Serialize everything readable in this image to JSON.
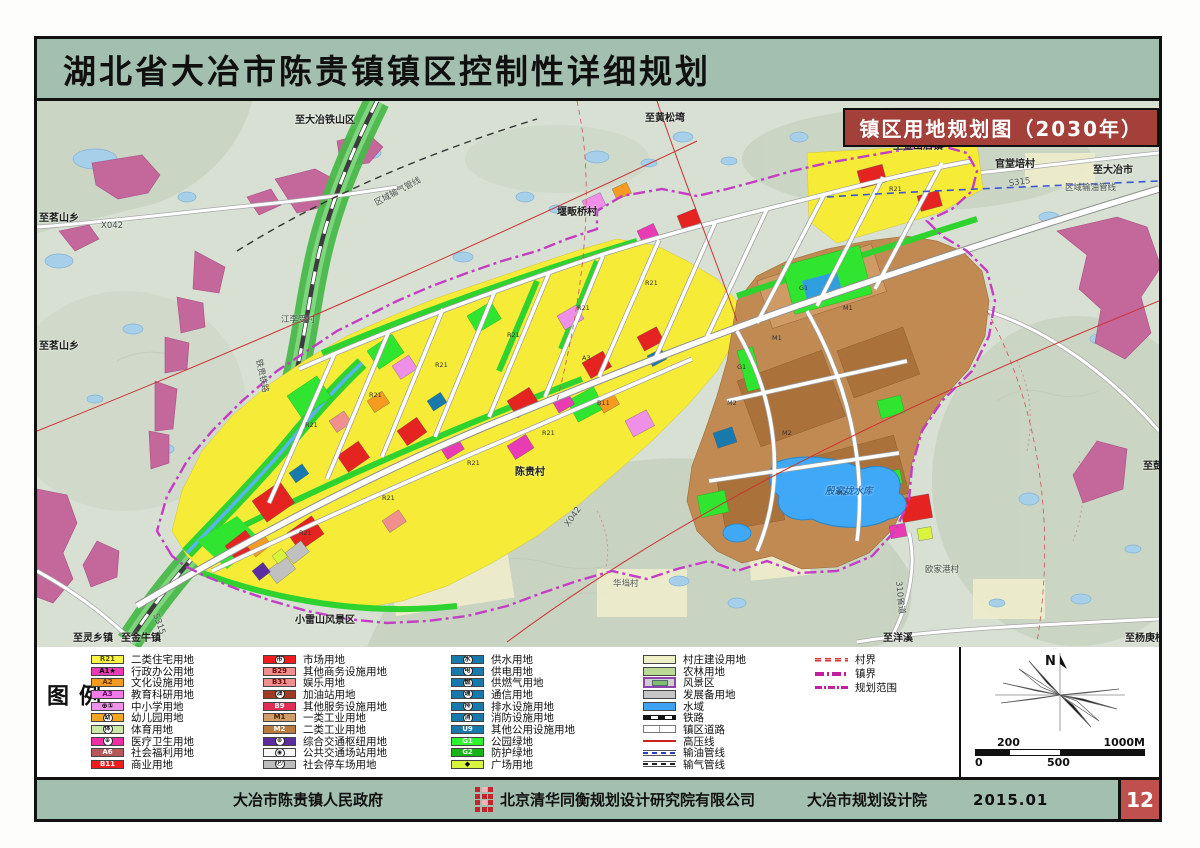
{
  "title": "湖北省大冶市陈贵镇镇区控制性详细规划",
  "badge": "镇区用地规划图（2030年）",
  "legend": {
    "title": "图例",
    "cols": [
      [
        {
          "c": "R21",
          "f": "#fdf546",
          "tc": "#555500",
          "label": "二类住宅用地"
        },
        {
          "c": "A1★",
          "f": "#e93cb4",
          "tc": "#000",
          "label": "行政办公用地"
        },
        {
          "c": "A2",
          "f": "#f59b21",
          "tc": "#6a3500",
          "label": "文化设施用地"
        },
        {
          "c": "A3",
          "f": "#f07ae8",
          "tc": "#6a006a",
          "label": "教育科研用地"
        },
        {
          "c": "⊕①",
          "f": "#ef93ea",
          "tc": "#000",
          "label": "中小学用地"
        },
        {
          "c": "幼",
          "f": "#f5a623",
          "circle": true,
          "label": "幼儿园用地"
        },
        {
          "c": "体",
          "f": "#cde8a6",
          "circle": true,
          "label": "体育用地"
        },
        {
          "c": "⊕",
          "f": "#ee2fa4",
          "circle": true,
          "label": "医疗卫生用地"
        },
        {
          "c": "A6",
          "f": "#b35959",
          "tc": "#fff",
          "label": "社会福利用地"
        },
        {
          "c": "B11",
          "f": "#ee1c1c",
          "tc": "#fff",
          "label": "商业用地"
        }
      ],
      [
        {
          "c": "市",
          "f": "#ee1c1c",
          "circle": true,
          "label": "市场用地"
        },
        {
          "c": "B29",
          "f": "#f18f8f",
          "tc": "#6a0a0a",
          "label": "其他商务设施用地"
        },
        {
          "c": "B31",
          "f": "#f18f8f",
          "tc": "#6a0a0a",
          "label": "娱乐用地"
        },
        {
          "c": "油",
          "f": "#9e3b22",
          "circle": true,
          "label": "加油站用地"
        },
        {
          "c": "B9",
          "f": "#e02d55",
          "tc": "#fff",
          "label": "其他服务设施用地"
        },
        {
          "c": "M1",
          "f": "#d29d66",
          "tc": "#4a2600",
          "label": "一类工业用地"
        },
        {
          "c": "M2",
          "f": "#b9793f",
          "tc": "#fff",
          "label": "二类工业用地"
        },
        {
          "c": "⊛",
          "f": "#5b2da0",
          "circle": true,
          "label": "综合交通枢纽用地"
        },
        {
          "c": "◉",
          "f": "#f7f7f7",
          "circle": true,
          "label": "公共交通场站用地"
        },
        {
          "c": "Ⓟ",
          "f": "#bdbdbd",
          "circle": true,
          "label": "社会停车场用地"
        }
      ],
      [
        {
          "c": "水",
          "f": "#1879ad",
          "circle": true,
          "label": "供水用地"
        },
        {
          "c": "电",
          "f": "#1879ad",
          "circle": true,
          "label": "供电用地"
        },
        {
          "c": "燃",
          "f": "#1879ad",
          "circle": true,
          "label": "供燃气用地"
        },
        {
          "c": "通",
          "f": "#1879ad",
          "circle": true,
          "label": "通信用地"
        },
        {
          "c": "排",
          "f": "#1879ad",
          "circle": true,
          "label": "排水设施用地"
        },
        {
          "c": "消",
          "f": "#1879ad",
          "circle": true,
          "label": "消防设施用地"
        },
        {
          "c": "U9",
          "f": "#1879ad",
          "tc": "#fff",
          "label": "其他公用设施用地"
        },
        {
          "c": "G1",
          "f": "#2ef52e",
          "tc": "#fff",
          "label": "公园绿地"
        },
        {
          "c": "G2",
          "f": "#17b417",
          "tc": "#fff",
          "label": "防护绿地"
        },
        {
          "c": "◆",
          "f": "#d9f43c",
          "tc": "#000",
          "label": "广场用地"
        }
      ],
      [
        {
          "c": "",
          "f": "#ecf0c4",
          "label": "村庄建设用地"
        },
        {
          "c": "",
          "f": "#b9d995",
          "label": "农林用地"
        },
        {
          "kind": "scenic",
          "label": "风景区"
        },
        {
          "c": "",
          "f": "#c6c6c6",
          "label": "发展备用地"
        },
        {
          "c": "",
          "f": "#3fa3f5",
          "label": "水域"
        },
        {
          "kind": "railway",
          "label": "铁路"
        },
        {
          "kind": "road",
          "label": "镇区道路"
        },
        {
          "kind": "hv",
          "label": "高压线"
        },
        {
          "kind": "oil",
          "label": "输油管线"
        },
        {
          "kind": "gas",
          "label": "输气管线"
        }
      ],
      [
        {
          "kind": "village-b",
          "label": "村界"
        },
        {
          "kind": "town-b",
          "label": "镇界"
        },
        {
          "kind": "plan-b",
          "label": "规划范围"
        }
      ]
    ]
  },
  "compass": {
    "north_label": "N"
  },
  "scale_bar": {
    "upper_left": "200",
    "upper_right": "1000M",
    "lower_left": "0",
    "lower_mid": "500"
  },
  "footer": {
    "government": "大冶市陈贵镇人民政府",
    "design_company": "北京清华同衡规划设计研究院有限公司",
    "local_institute": "大冶市规划设计院",
    "date": "2015.01",
    "page_number": "12"
  },
  "colors": {
    "title_bg": "#a3bfb0",
    "badge_bg": "#a4403a",
    "page_box_bg": "#c0504d",
    "plan_boundary": "#c43ec4"
  },
  "map": {
    "labels": [
      {
        "text": "至大冶铁山区",
        "x": 258,
        "y": 10
      },
      {
        "text": "X042",
        "x": 64,
        "y": 120,
        "cls": "small"
      },
      {
        "text": "至茗山乡",
        "x": 2,
        "y": 108
      },
      {
        "text": "至茗山乡",
        "x": 2,
        "y": 236
      },
      {
        "text": "至黄松塆",
        "x": 608,
        "y": 8
      },
      {
        "text": "堰畈桥村",
        "x": 520,
        "y": 102
      },
      {
        "text": "官堂培村",
        "x": 958,
        "y": 54
      },
      {
        "text": "至金山店镇",
        "x": 856,
        "y": 36
      },
      {
        "text": "至大冶市",
        "x": 1056,
        "y": 60
      },
      {
        "text": "S315",
        "x": 972,
        "y": 78,
        "rot": -8,
        "cls": "small"
      },
      {
        "text": "区域输油管线",
        "x": 1028,
        "y": 80,
        "cls": "small"
      },
      {
        "text": "区域输气管线",
        "x": 338,
        "y": 96,
        "rot": -28,
        "cls": "small"
      },
      {
        "text": "铁贵铁路",
        "x": 222,
        "y": 252,
        "rot": 78,
        "cls": "small"
      },
      {
        "text": "江李受村",
        "x": 244,
        "y": 212,
        "cls": "small"
      },
      {
        "text": "陈贵村",
        "x": 478,
        "y": 362
      },
      {
        "text": "小雷山风景区",
        "x": 258,
        "y": 510
      },
      {
        "text": "华垱村",
        "x": 576,
        "y": 476,
        "cls": "small"
      },
      {
        "text": "欧家港村",
        "x": 888,
        "y": 462,
        "cls": "small"
      },
      {
        "text": "殷家垅水库",
        "x": 788,
        "y": 382,
        "cls": "water"
      },
      {
        "text": "至洋溪",
        "x": 846,
        "y": 528
      },
      {
        "text": "至杨庚桥",
        "x": 1088,
        "y": 528
      },
      {
        "text": "至彭家",
        "x": 1106,
        "y": 356
      },
      {
        "text": "至灵乡镇",
        "x": 36,
        "y": 528
      },
      {
        "text": "至金牛镇",
        "x": 84,
        "y": 528
      },
      {
        "text": "S315",
        "x": 118,
        "y": 508,
        "rot": 70,
        "cls": "small"
      },
      {
        "text": "X042",
        "x": 530,
        "y": 420,
        "rot": -55,
        "cls": "small"
      },
      {
        "text": "310省道",
        "x": 862,
        "y": 474,
        "rot": 84,
        "cls": "small"
      }
    ],
    "parcel_codes": [
      {
        "t": "R21",
        "x": 268,
        "y": 320
      },
      {
        "t": "R21",
        "x": 332,
        "y": 290
      },
      {
        "t": "R21",
        "x": 398,
        "y": 260
      },
      {
        "t": "R21",
        "x": 470,
        "y": 230
      },
      {
        "t": "R21",
        "x": 540,
        "y": 203
      },
      {
        "t": "R21",
        "x": 608,
        "y": 178
      },
      {
        "t": "R21",
        "x": 345,
        "y": 393
      },
      {
        "t": "R21",
        "x": 262,
        "y": 428
      },
      {
        "t": "R21",
        "x": 430,
        "y": 358
      },
      {
        "t": "R21",
        "x": 505,
        "y": 328
      },
      {
        "t": "R21",
        "x": 852,
        "y": 84
      },
      {
        "t": "B11",
        "x": 560,
        "y": 298
      },
      {
        "t": "A3",
        "x": 545,
        "y": 253
      },
      {
        "t": "M1",
        "x": 735,
        "y": 233
      },
      {
        "t": "M1",
        "x": 806,
        "y": 203
      },
      {
        "t": "M2",
        "x": 745,
        "y": 328
      },
      {
        "t": "M2",
        "x": 800,
        "y": 388
      },
      {
        "t": "M2",
        "x": 690,
        "y": 298
      },
      {
        "t": "G1",
        "x": 762,
        "y": 183
      },
      {
        "t": "G1",
        "x": 700,
        "y": 262
      }
    ]
  }
}
